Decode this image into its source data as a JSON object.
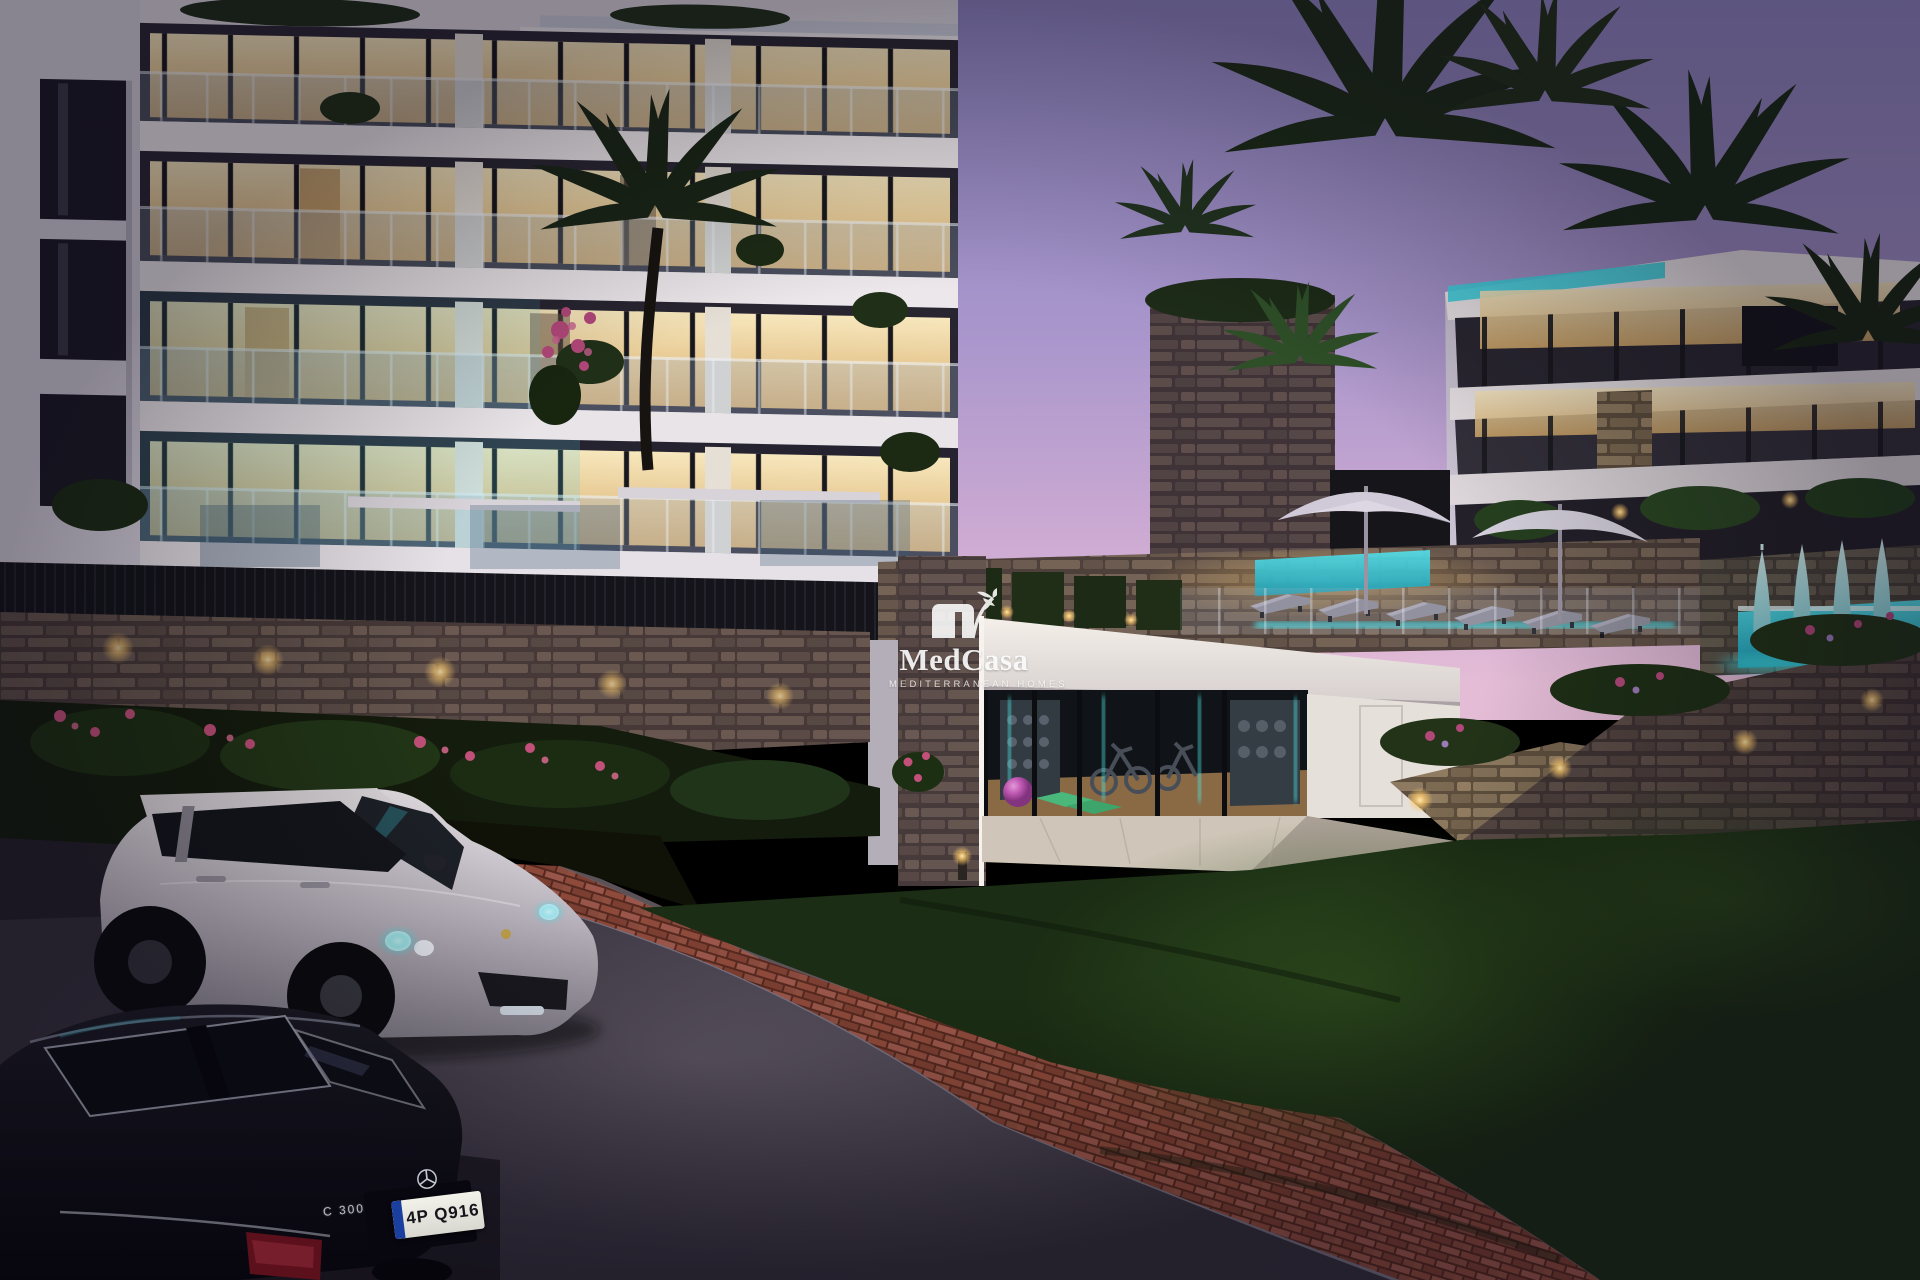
{
  "image": {
    "description": "Dusk architectural render of a modern Mediterranean apartment complex with terraced balconies, warm lit interiors, an illuminated basement gym, pool terraces with umbrellas, palm trees, stacked-stone walls, a white SUV and a black sedan parked on a curved road",
    "time_of_day": "dusk"
  },
  "watermark": {
    "brand": "MedCasa",
    "tagline": "MEDITERRANEAN HOMES",
    "logo": "palm-house-logo"
  },
  "vehicles": {
    "sedan": {
      "color": "black",
      "model_badge": "C 300",
      "license_plate": "4P Q916",
      "emblem": "mercedes-star-icon"
    },
    "suv": {
      "color": "white",
      "emblem": "porsche-crest-icon"
    }
  },
  "palette": {
    "sky_top": "#8f85c2",
    "sky_horizon": "#e4bcd6",
    "warm_light": "#f6e3b0",
    "teal_accent": "#45d8e4",
    "stone": "#8d7a60",
    "lawn": "#1c2f16",
    "road": "#4c4550",
    "brick": "#8e4a3c",
    "flowers": "#c2507a"
  }
}
